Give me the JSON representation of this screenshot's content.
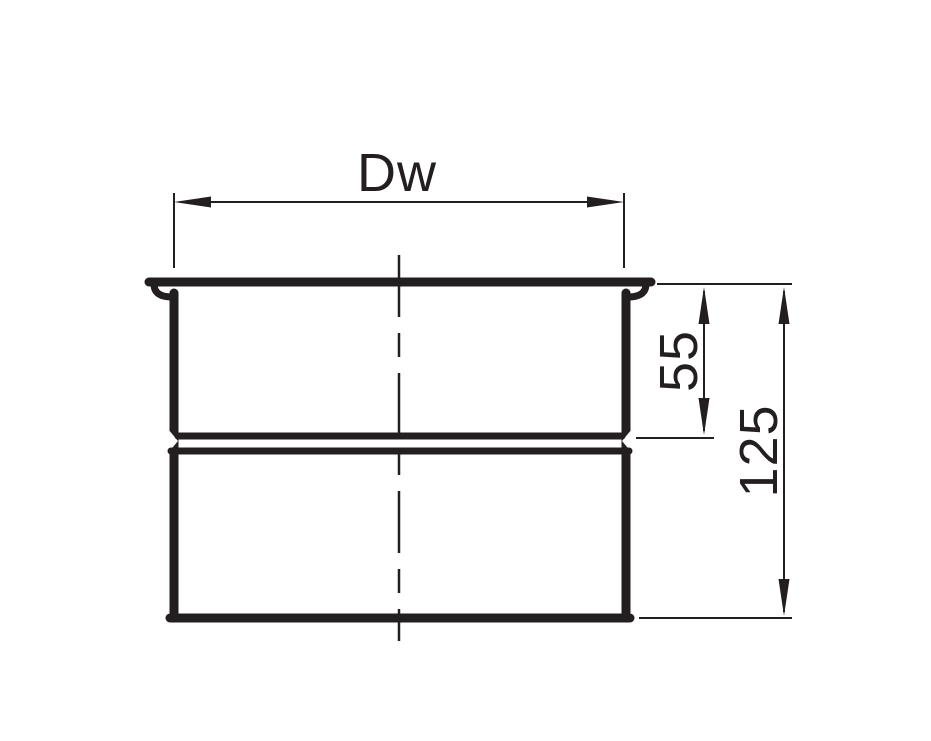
{
  "colors": {
    "ink": "#231f20",
    "background": "#ffffff"
  },
  "dimensions": {
    "width_label": "Dw",
    "socket_depth_label": "55",
    "overall_height_label": "125"
  }
}
